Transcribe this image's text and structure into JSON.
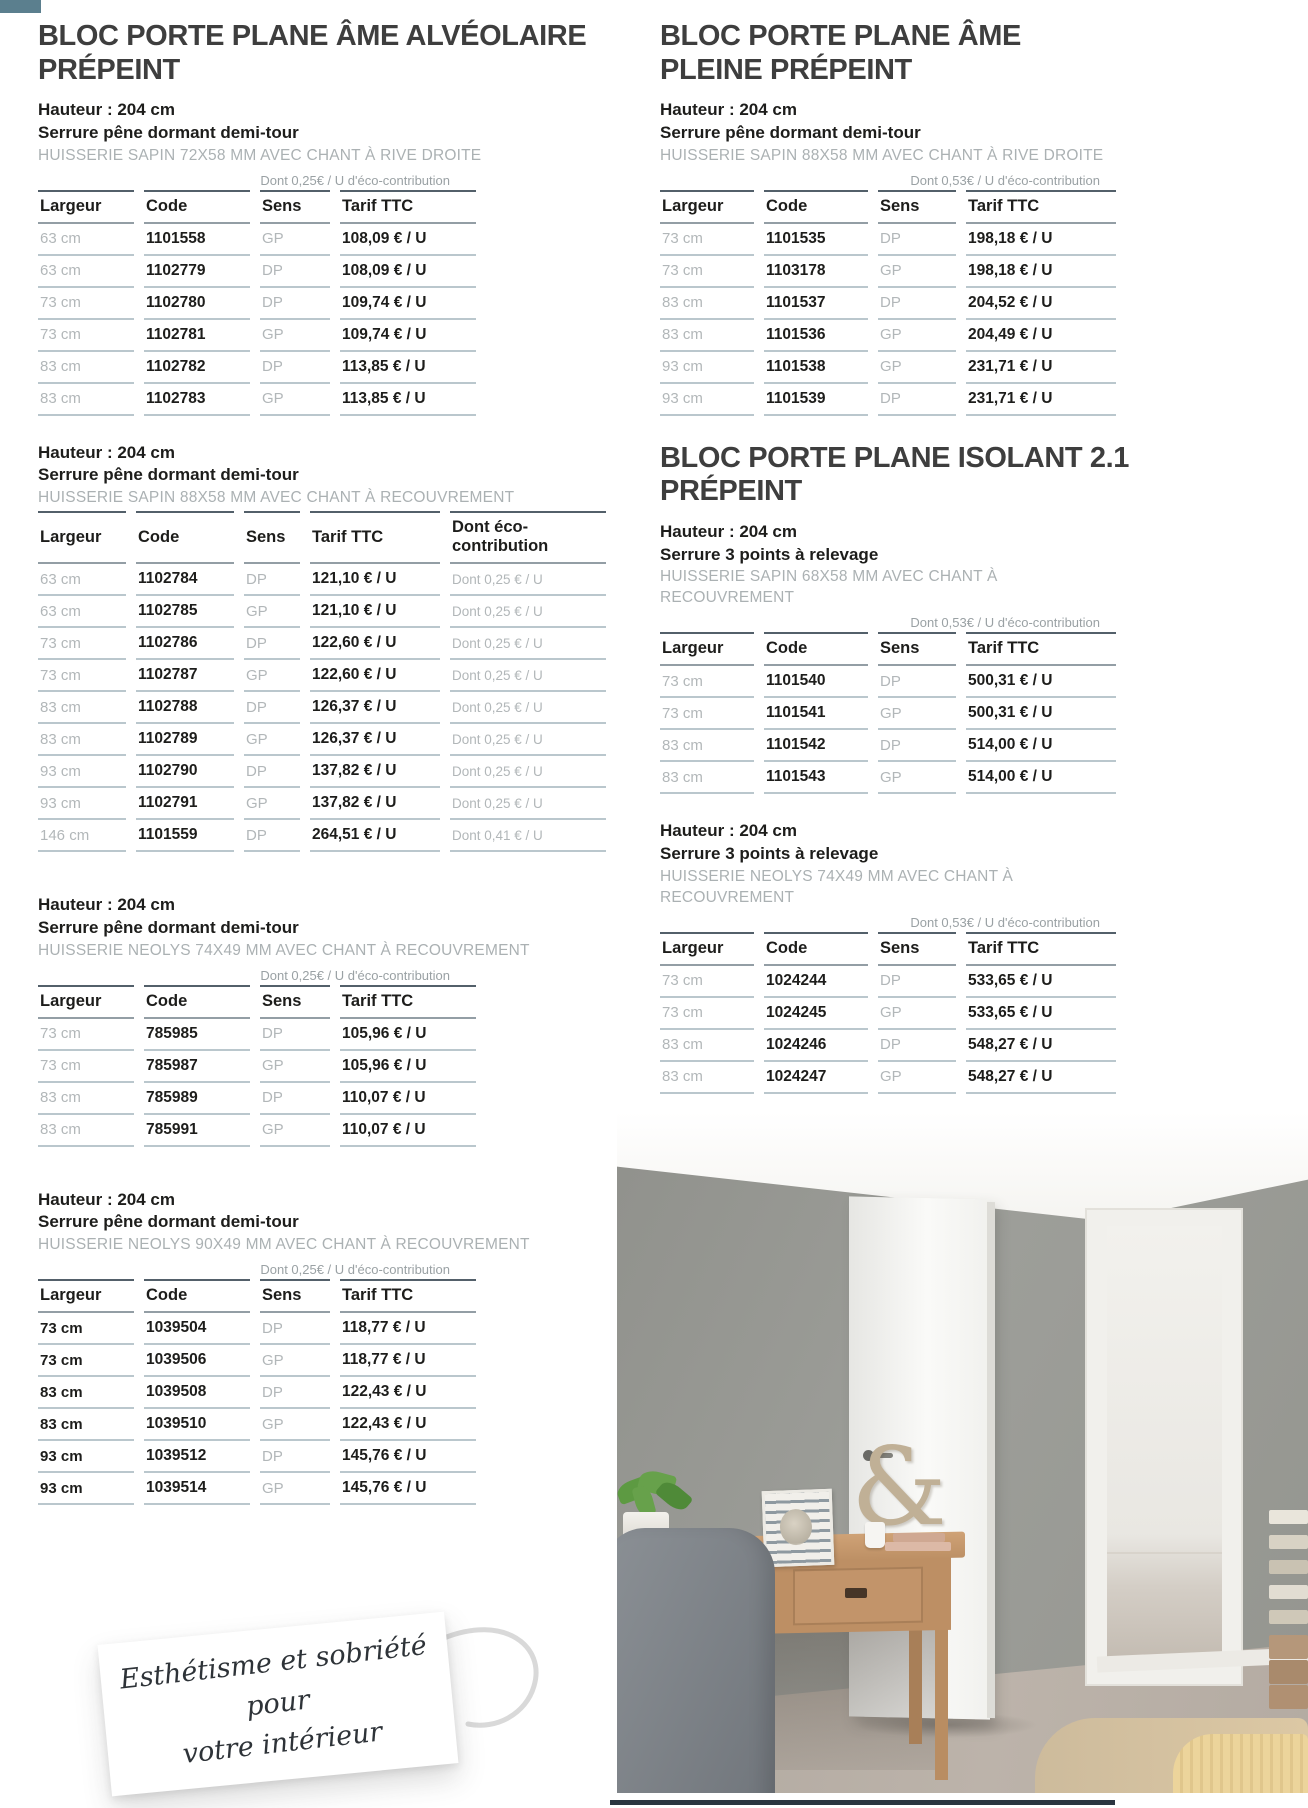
{
  "page": {
    "background": "#ffffff",
    "corner_color": "#5b7f8e"
  },
  "products": [
    {
      "title": "BLOC PORTE PLANE ÂME ALVÉOLAIRE PRÉPEINT",
      "column": "left",
      "variants": [
        {
          "specs": [
            "Hauteur : 204 cm",
            "Serrure pêne dormant demi-tour"
          ],
          "huisserie": "HUISSERIE SAPIN 72X58 MM AVEC CHANT À RIVE DROITE",
          "eco_note": "Dont 0,25€ / U d'éco-contribution",
          "columns": [
            "Largeur",
            "Code",
            "Sens",
            "Tarif TTC"
          ],
          "rows": [
            [
              "63 cm",
              "1101558",
              "GP",
              "108,09 € / U"
            ],
            [
              "63 cm",
              "1102779",
              "DP",
              "108,09 € / U"
            ],
            [
              "73 cm",
              "1102780",
              "DP",
              "109,74 € / U"
            ],
            [
              "73 cm",
              "1102781",
              "GP",
              "109,74 € / U"
            ],
            [
              "83 cm",
              "1102782",
              "DP",
              "113,85 € / U"
            ],
            [
              "83 cm",
              "1102783",
              "GP",
              "113,85 € / U"
            ]
          ]
        },
        {
          "specs": [
            "Hauteur : 204 cm",
            "Serrure pêne dormant demi-tour"
          ],
          "huisserie": "HUISSERIE SAPIN 88X58 MM AVEC CHANT À RECOUVREMENT",
          "eco_note": null,
          "columns": [
            "Largeur",
            "Code",
            "Sens",
            "Tarif TTC",
            "Dont éco-contribution"
          ],
          "rows": [
            [
              "63 cm",
              "1102784",
              "DP",
              "121,10 € / U",
              "Dont 0,25 € / U"
            ],
            [
              "63 cm",
              "1102785",
              "GP",
              "121,10 € / U",
              "Dont 0,25 € / U"
            ],
            [
              "73 cm",
              "1102786",
              "DP",
              "122,60 € / U",
              "Dont 0,25 € / U"
            ],
            [
              "73 cm",
              "1102787",
              "GP",
              "122,60 € / U",
              "Dont 0,25 € / U"
            ],
            [
              "83 cm",
              "1102788",
              "DP",
              "126,37 € / U",
              "Dont 0,25 € / U"
            ],
            [
              "83 cm",
              "1102789",
              "GP",
              "126,37 € / U",
              "Dont 0,25 € / U"
            ],
            [
              "93 cm",
              "1102790",
              "DP",
              "137,82 € / U",
              "Dont 0,25 € / U"
            ],
            [
              "93 cm",
              "1102791",
              "GP",
              "137,82 € / U",
              "Dont 0,25 € / U"
            ],
            [
              "146 cm",
              "1101559",
              "DP",
              "264,51 € / U",
              "Dont 0,41 € / U"
            ]
          ]
        },
        {
          "specs": [
            "Hauteur : 204 cm",
            "Serrure pêne dormant demi-tour"
          ],
          "huisserie": "HUISSERIE NEOLYS 74X49 MM AVEC CHANT À RECOUVREMENT",
          "eco_note": "Dont 0,25€ / U d'éco-contribution",
          "columns": [
            "Largeur",
            "Code",
            "Sens",
            "Tarif TTC"
          ],
          "rows": [
            [
              "73 cm",
              "785985",
              "DP",
              "105,96 € / U"
            ],
            [
              "73 cm",
              "785987",
              "GP",
              "105,96 € / U"
            ],
            [
              "83 cm",
              "785989",
              "DP",
              "110,07 € / U"
            ],
            [
              "83 cm",
              "785991",
              "GP",
              "110,07 € / U"
            ]
          ]
        },
        {
          "specs": [
            "Hauteur : 204 cm",
            "Serrure pêne dormant demi-tour"
          ],
          "huisserie": "HUISSERIE NEOLYS 90X49 MM AVEC CHANT À RECOUVREMENT",
          "eco_note": "Dont 0,25€ / U d'éco-contribution",
          "columns": [
            "Largeur",
            "Code",
            "Sens",
            "Tarif TTC"
          ],
          "largeur_style": "bold",
          "rows": [
            [
              "73 cm",
              "1039504",
              "DP",
              "118,77 € / U"
            ],
            [
              "73 cm",
              "1039506",
              "GP",
              "118,77 € / U"
            ],
            [
              "83 cm",
              "1039508",
              "DP",
              "122,43 € / U"
            ],
            [
              "83 cm",
              "1039510",
              "GP",
              "122,43 € / U"
            ],
            [
              "93 cm",
              "1039512",
              "DP",
              "145,76 € / U"
            ],
            [
              "93 cm",
              "1039514",
              "GP",
              "145,76 € / U"
            ]
          ]
        }
      ]
    },
    {
      "title": "BLOC PORTE PLANE ÂME PLEINE PRÉPEINT",
      "column": "right",
      "variants": [
        {
          "specs": [
            "Hauteur : 204 cm",
            "Serrure pêne dormant demi-tour"
          ],
          "huisserie": "HUISSERIE SAPIN 88X58 MM AVEC CHANT À RIVE DROITE",
          "eco_note": "Dont 0,53€ / U d'éco-contribution",
          "columns": [
            "Largeur",
            "Code",
            "Sens",
            "Tarif TTC"
          ],
          "rows": [
            [
              "73 cm",
              "1101535",
              "DP",
              "198,18 € / U"
            ],
            [
              "73 cm",
              "1103178",
              "GP",
              "198,18 € / U"
            ],
            [
              "83 cm",
              "1101537",
              "DP",
              "204,52 € / U"
            ],
            [
              "83 cm",
              "1101536",
              "GP",
              "204,49 € / U"
            ],
            [
              "93 cm",
              "1101538",
              "GP",
              "231,71 € / U"
            ],
            [
              "93 cm",
              "1101539",
              "DP",
              "231,71 € / U"
            ]
          ]
        }
      ]
    },
    {
      "title": "BLOC PORTE PLANE ISOLANT 2.1 PRÉPEINT",
      "column": "right",
      "variants": [
        {
          "specs": [
            "Hauteur : 204 cm",
            "Serrure 3 points à relevage"
          ],
          "huisserie": "HUISSERIE SAPIN 68X58 MM AVEC CHANT À RECOUVREMENT",
          "eco_note": "Dont 0,53€ / U d'éco-contribution",
          "columns": [
            "Largeur",
            "Code",
            "Sens",
            "Tarif TTC"
          ],
          "rows": [
            [
              "73 cm",
              "1101540",
              "DP",
              "500,31 € / U"
            ],
            [
              "73 cm",
              "1101541",
              "GP",
              "500,31 € / U"
            ],
            [
              "83 cm",
              "1101542",
              "DP",
              "514,00 € / U"
            ],
            [
              "83 cm",
              "1101543",
              "GP",
              "514,00 € / U"
            ]
          ]
        },
        {
          "specs": [
            "Hauteur : 204 cm",
            "Serrure 3 points à relevage"
          ],
          "huisserie": "HUISSERIE NEOLYS 74X49 MM AVEC CHANT À RECOUVREMENT",
          "eco_note": "Dont 0,53€ / U d'éco-contribution",
          "columns": [
            "Largeur",
            "Code",
            "Sens",
            "Tarif TTC"
          ],
          "rows": [
            [
              "73 cm",
              "1024244",
              "DP",
              "533,65 € / U"
            ],
            [
              "73 cm",
              "1024245",
              "GP",
              "533,65 € / U"
            ],
            [
              "83 cm",
              "1024246",
              "DP",
              "548,27 € / U"
            ],
            [
              "83 cm",
              "1024247",
              "GP",
              "548,27 € / U"
            ]
          ]
        }
      ]
    }
  ],
  "note_card": {
    "text_line1": "Esthétisme et sobriété pour",
    "text_line2": "votre intérieur"
  },
  "photo": {
    "description": "Bedroom interior: grey walls, white ceiling, open white plane door onto a hallway, wooden writing desk with drawer, grey upholstered chair, potted plant, patterned picture frame, decorative ampersand, cup and books on desk, beige carpet, knitted yellow bedspread in corner, stack of books at right edge",
    "ampersand": "&",
    "colors": {
      "wall": "#9a9b96",
      "door": "#f6f6f3",
      "carpet": "#b4aba2",
      "desk_wood": "#c0946a",
      "chair": "#7d8288",
      "bedspread": "#ecd49b"
    }
  }
}
